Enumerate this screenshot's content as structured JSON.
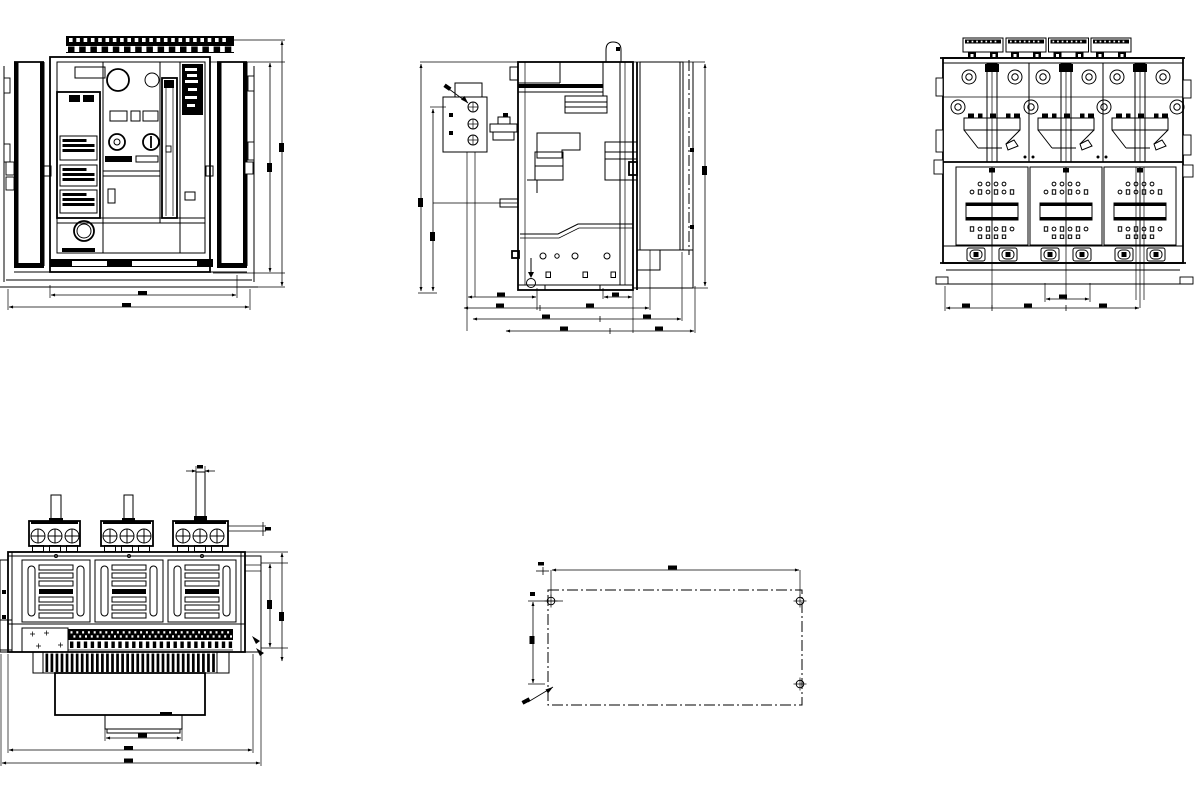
{
  "sheet": {
    "background": "#ffffff",
    "line_color": "#000000",
    "content": "dimensional outline drawing of a three-pole drawout air circuit breaker, five orthographic views, dimension text illegible at this resolution"
  },
  "views": {
    "front_view": {
      "top_terminal_slots": 22,
      "top_terminal_tabs": 15,
      "nameplate_label_blocks": 3,
      "label_block_y": [
        136,
        165,
        190
      ],
      "label_block_h": [
        24,
        21,
        23
      ]
    },
    "side_view": {
      "terminal_block_holes": 3,
      "bottom_dimension_rows": 4
    },
    "rear_view": {
      "poles": 3,
      "pole_centers": [
        992,
        1066,
        1140
      ],
      "top_terminal_groups": 4,
      "terminal_group_dots": 7,
      "grid_holes_wide_row": 6,
      "grid_holes_narrow_row": 4,
      "bottom_bolts_per_pole": 2
    },
    "top_view": {
      "poles": 3,
      "terminals_per_pole": 3,
      "terminal_centers": [
        [
          38,
          55,
          72
        ],
        [
          110,
          127,
          144
        ],
        [
          183,
          200,
          217
        ]
      ],
      "cluster_x": [
        29,
        101,
        173
      ],
      "cluster_w": [
        51,
        52,
        55
      ],
      "vent_panel_x": [
        22,
        95,
        168
      ],
      "vent_slats_per_pole": 7,
      "comb_fins": 34,
      "strip_dot_columns": 28,
      "strip_square_count": 24
    },
    "mounting_plan": {
      "visible_holes": 3,
      "outline_style": "dash-dot"
    }
  }
}
